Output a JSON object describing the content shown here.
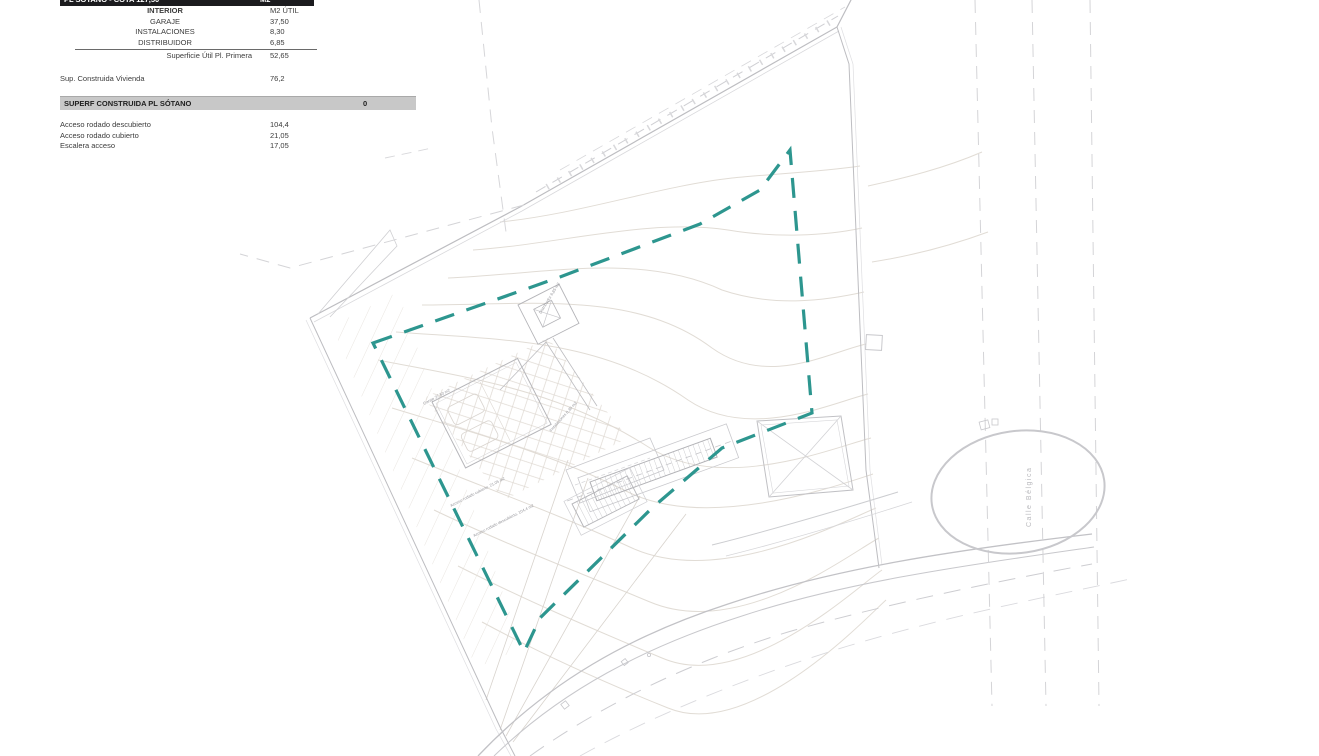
{
  "table": {
    "header": {
      "title": "PL SÓTANO - COTA 127,50",
      "unit": "M2"
    },
    "subheader": {
      "label": "INTERIOR",
      "unit": "M2 ÚTIL"
    },
    "rows": [
      {
        "label": "GARAJE",
        "value": "37,50"
      },
      {
        "label": "INSTALACIONES",
        "value": "8,30"
      },
      {
        "label": "DISTRIBUIDOR",
        "value": "6,85"
      }
    ],
    "subtotal": {
      "label": "Superficie Útil Pl. Primera",
      "value": "52,65"
    },
    "built": {
      "label": "Sup. Construida Vivienda",
      "value": "76,2"
    },
    "section_bar": {
      "label": "SUPERF CONSTRUIDA PL SÓTANO",
      "value": "0"
    },
    "exterior_rows": [
      {
        "label": "Acceso rodado descubierto",
        "value": "104,4"
      },
      {
        "label": "Acceso rodado cubierto",
        "value": "21,05"
      },
      {
        "label": "Escalera acceso",
        "value": "17,05"
      }
    ]
  },
  "plan": {
    "street_label": "Calle  Bélgica",
    "labels": {
      "garage": "Garaje 37,50 m2",
      "instalaciones": "Instalaciones 8,30 m2",
      "distribuidor": "Distribuidor 6,85 m2",
      "acceso_cubierto": "Acceso rodado cubierto, 21,05 m2",
      "acceso_descubierto": "Acceso rodado descubierto, 104,4 m2"
    },
    "colors": {
      "boundary_teal": "#2d968f",
      "cad_gray": "#c2c2c6",
      "contour_tan": "#e1dcd5",
      "header_dark": "#1b1b1e",
      "section_gray": "#c8c8c8"
    }
  }
}
